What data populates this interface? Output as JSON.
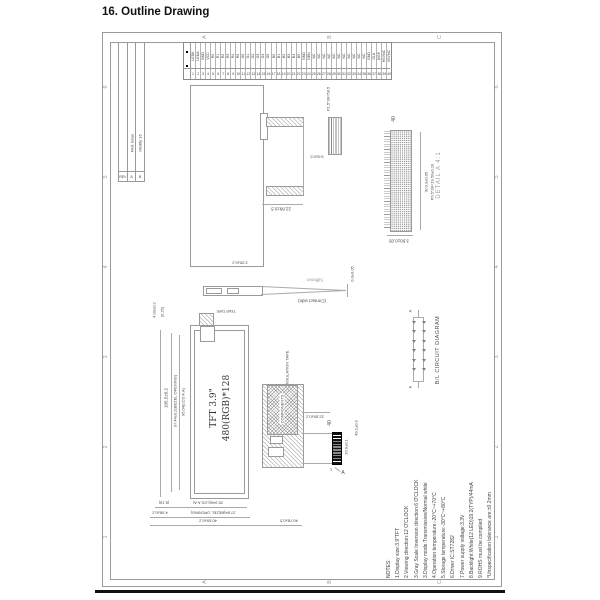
{
  "page": {
    "title": "16. Outline Drawing"
  },
  "colors": {
    "line": "#9a9a9a",
    "text": "#4a4a4a",
    "footer_bar": "#111111"
  },
  "frame": {
    "zones_top": [
      "A",
      "B",
      "C"
    ],
    "zones_bottom": [
      "A",
      "B",
      "C"
    ],
    "zones_left": [
      "6",
      "5",
      "4",
      "3",
      "2",
      "1"
    ],
    "zones_right": [
      "6",
      "5",
      "4",
      "3",
      "2",
      "1"
    ]
  },
  "revision_table": {
    "header": "REV",
    "rows": [
      {
        "rev": "A",
        "desc": "First Issue"
      },
      {
        "rev": "B",
        "desc": "Modify 16"
      }
    ]
  },
  "pin_table": {
    "pins": [
      {
        "n": "1",
        "s": "LEDK"
      },
      {
        "n": "2",
        "s": "LEDA"
      },
      {
        "n": "3",
        "s": "GND"
      },
      {
        "n": "4",
        "s": "VCC"
      },
      {
        "n": "5",
        "s": "R0"
      },
      {
        "n": "6",
        "s": "R1"
      },
      {
        "n": "7",
        "s": "R2"
      },
      {
        "n": "8",
        "s": "R3"
      },
      {
        "n": "9",
        "s": "R4"
      },
      {
        "n": "10",
        "s": "R5"
      },
      {
        "n": "11",
        "s": "G0"
      },
      {
        "n": "12",
        "s": "G1"
      },
      {
        "n": "13",
        "s": "G2"
      },
      {
        "n": "14",
        "s": "G3"
      },
      {
        "n": "15",
        "s": "G4"
      },
      {
        "n": "16",
        "s": "G5"
      },
      {
        "n": "17",
        "s": "B0"
      },
      {
        "n": "18",
        "s": "B1"
      },
      {
        "n": "19",
        "s": "B2"
      },
      {
        "n": "20",
        "s": "B3"
      },
      {
        "n": "21",
        "s": "B4"
      },
      {
        "n": "22",
        "s": "B5"
      },
      {
        "n": "23",
        "s": "GND"
      },
      {
        "n": "24",
        "s": "DEN"
      },
      {
        "n": "25",
        "s": "NC"
      },
      {
        "n": "26",
        "s": "NC"
      },
      {
        "n": "27",
        "s": "NC"
      },
      {
        "n": "28",
        "s": "NC"
      },
      {
        "n": "29",
        "s": "NC"
      },
      {
        "n": "30",
        "s": "NC"
      },
      {
        "n": "31",
        "s": "NC"
      },
      {
        "n": "32",
        "s": "NC"
      },
      {
        "n": "33",
        "s": "NC"
      },
      {
        "n": "34",
        "s": "NC"
      },
      {
        "n": "35",
        "s": "NC"
      },
      {
        "n": "36",
        "s": "GND"
      },
      {
        "n": "37",
        "s": "CLK"
      },
      {
        "n": "38",
        "s": "DISP"
      },
      {
        "n": "39",
        "s": "HSYNC"
      },
      {
        "n": "40",
        "s": "VSYNC"
      }
    ]
  },
  "side_view": {
    "pitch_label": "P1.5*39=58.5",
    "height_dim": "9.0±0.5",
    "fold_dim": "22.89±0.5"
  },
  "detail_a": {
    "pin_count": "40",
    "dim_line1": "W:0.3±0.05",
    "dim_line2": "P0.5*39=19.50±0.10",
    "width_dim": "3.50±0.05",
    "title": "DETAIL A 4:1"
  },
  "fpc_top": {
    "stiffener": "Stiffener",
    "contact_side": "(Contact side)",
    "thickness_dim": "0.3±0.05",
    "width_dim": "2.95±0.2"
  },
  "front_view": {
    "line1": "TFT 3.9\"",
    "line2": "480(RGB)*128",
    "tear_tape": "TEAR TAPE",
    "dim_left_outer": "105.5±0.2",
    "dim_left_mid": "97.44±0.2(BEZEL OPENING)",
    "dim_left_inner": "95.04(LCD A.A)",
    "dim_top1": "4.03±0.2",
    "dim_top2": "(5.25)",
    "dim_bot1": "(8.18)",
    "dim_bot2": "25.344(LCD A.A)",
    "dim_bot3": "4.98±0.2",
    "dim_bot4": "27.84(BEZEL OPENING)",
    "dim_bot5": "40.69±0.2",
    "dim_bot6": "46.78±0.5"
  },
  "fpc_back": {
    "insulation": "INSULATION TAPE",
    "components": "COMPONENTS",
    "width_dim": "22.89±0.2",
    "pin_count": "40",
    "finger_dim": "20.9±0.1",
    "length_dim": "49.1±0.3",
    "pin1": "1",
    "detail_ref": "A"
  },
  "bl_circuit": {
    "title": "B/L CIRCUIT DIAGRAM",
    "anode": "A",
    "cathode": "K",
    "led_count": 12
  },
  "notes": {
    "lines": [
      "NOTES:",
      "1.Display size:3.9\"TFT",
      "2.Viewing direction:12 O'CLOCK",
      "3.Gray Scale Inversion direction:6 O'CLOCK",
      "3.Display mode:Transmissive/Normal white",
      "4.Operation temperature:-20°C~+70°C",
      "5.Storage temperature:-30°C~+80°C",
      "6.Driver IC:ST7282",
      "7.Power supply voltage:3.3V",
      "8.Backlight:White(12 LED)19.2(TYP)/44mA",
      "9.ROHS must be complied",
      "*Unspecification tolerance are:±0.2mm"
    ]
  }
}
